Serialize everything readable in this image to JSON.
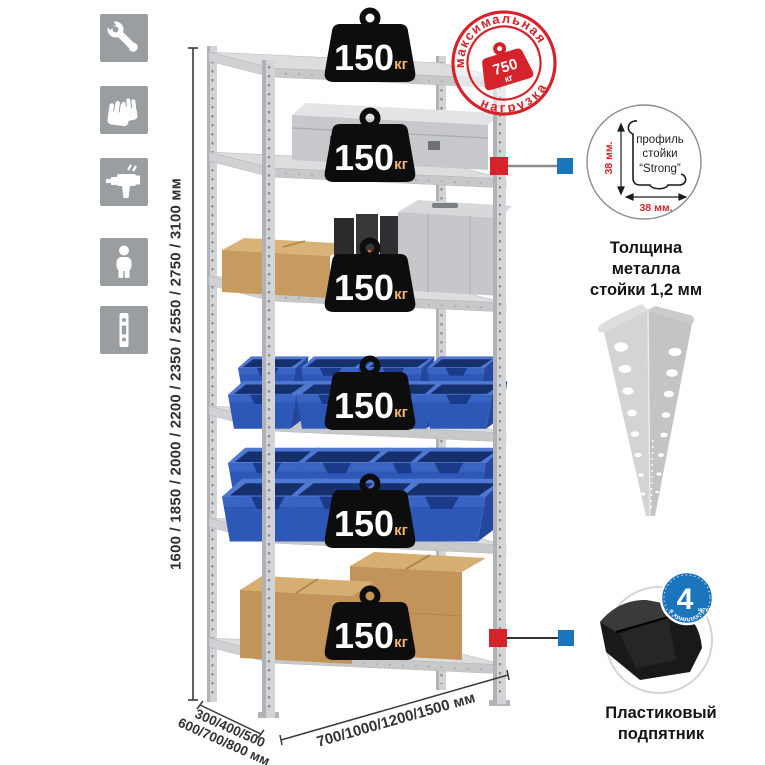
{
  "colors": {
    "accent_red": "#d5232b",
    "accent_blue": "#1b75bc",
    "icon_gray": "#9b9ea0",
    "metal_light": "#d7d8da",
    "bin_blue": "#2e58b8"
  },
  "sidebar": {
    "icons": [
      {
        "name": "wrench-icon"
      },
      {
        "name": "gloves-icon"
      },
      {
        "name": "drill-icon"
      },
      {
        "name": "person-icon"
      },
      {
        "name": "post-profile-icon"
      }
    ]
  },
  "height_dim": {
    "label": "1600 / 1850 / 2000 / 2200 / 2350 / 2550 / 2750 / 3100 мм"
  },
  "width_dim": {
    "label": "700/1000/1200/1500 мм"
  },
  "depth_dim": {
    "line1": "300/400/500",
    "line2": "600/700/800 мм"
  },
  "shelves": {
    "weights": [
      {
        "value": "150",
        "unit": "кг"
      },
      {
        "value": "150",
        "unit": "кг"
      },
      {
        "value": "150",
        "unit": "кг"
      },
      {
        "value": "150",
        "unit": "кг"
      },
      {
        "value": "150",
        "unit": "кг"
      },
      {
        "value": "150",
        "unit": "кг"
      }
    ]
  },
  "stamp": {
    "arc_top": "максимальная",
    "arc_bottom": "нагрузка",
    "value": "750",
    "unit": "кг"
  },
  "profile_detail": {
    "text_line1": "профиль",
    "text_line2": "стойки",
    "text_line3": "“Strong”",
    "dim_v": "38 мм.",
    "dim_h": "38 мм.",
    "caption1": "Толщина металла",
    "caption2": "стойки 1,2 мм"
  },
  "foot_detail": {
    "badge_number": "4",
    "badge_unit": "штуки",
    "badge_arc": "в комплекте",
    "caption1": "Пластиковый",
    "caption2": "подпятник"
  }
}
